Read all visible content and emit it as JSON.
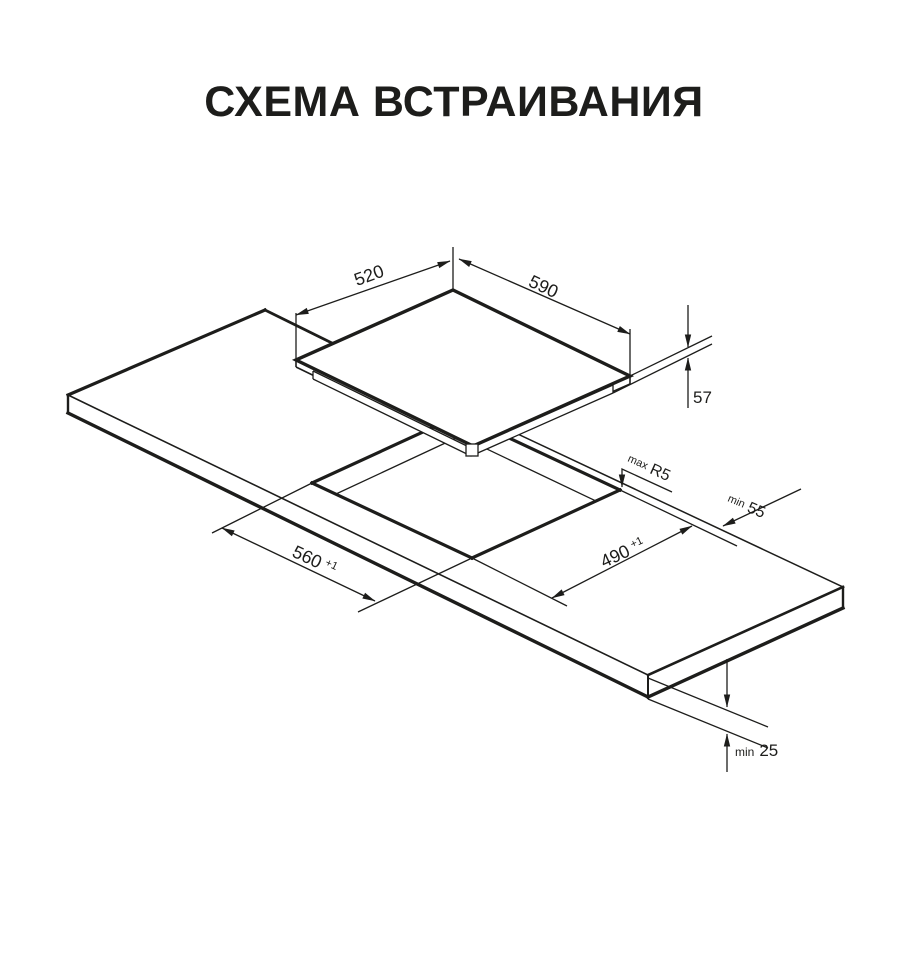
{
  "title": "СХЕМА ВСТРАИВАНИЯ",
  "dims": {
    "top_depth": {
      "value": "520"
    },
    "top_width": {
      "value": "590"
    },
    "hob_height": {
      "value": "57"
    },
    "cutout_length": {
      "value": "560",
      "sup": "+1"
    },
    "cutout_width": {
      "value": "490",
      "sup": "+1"
    },
    "corner_radius": {
      "prefix": "max",
      "value": "R5"
    },
    "rear_clearance": {
      "prefix": "min",
      "value": "55"
    },
    "top_thickness": {
      "prefix": "min",
      "value": "25"
    }
  },
  "colors": {
    "line": "#1d1d1b",
    "background": "#ffffff"
  }
}
